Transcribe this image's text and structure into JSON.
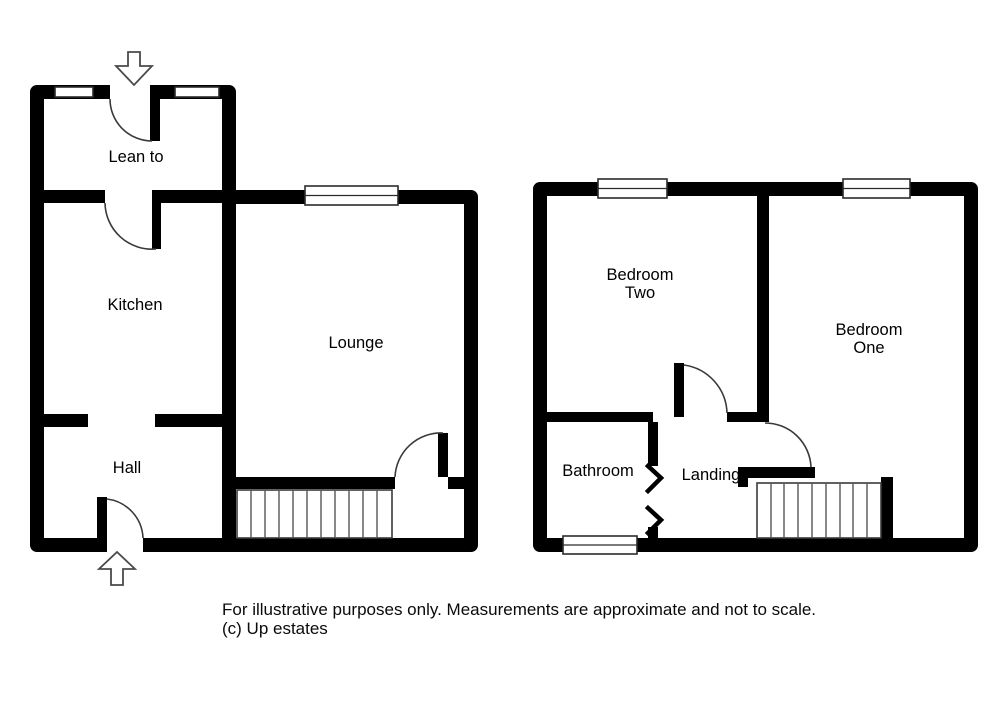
{
  "ground_floor": {
    "rooms": {
      "lean_to": "Lean to",
      "kitchen": "Kitchen",
      "hall": "Hall",
      "lounge": "Lounge"
    }
  },
  "first_floor": {
    "rooms": {
      "bedroom_two": {
        "line1": "Bedroom",
        "line2": "Two"
      },
      "bedroom_one": {
        "line1": "Bedroom",
        "line2": "One"
      },
      "bathroom": "Bathroom",
      "landing": "Landing"
    }
  },
  "footer": {
    "line1": "For illustrative purposes only. Measurements are approximate and not to scale.",
    "line2": "(c) Up estates"
  },
  "colors": {
    "wall": "#000000",
    "background": "#ffffff",
    "detail_line": "#3a3a3a"
  },
  "icons": {
    "entrance_top": "arrow-down",
    "entrance_bottom": "arrow-up",
    "bathroom_door": "folding-door-chevrons"
  }
}
